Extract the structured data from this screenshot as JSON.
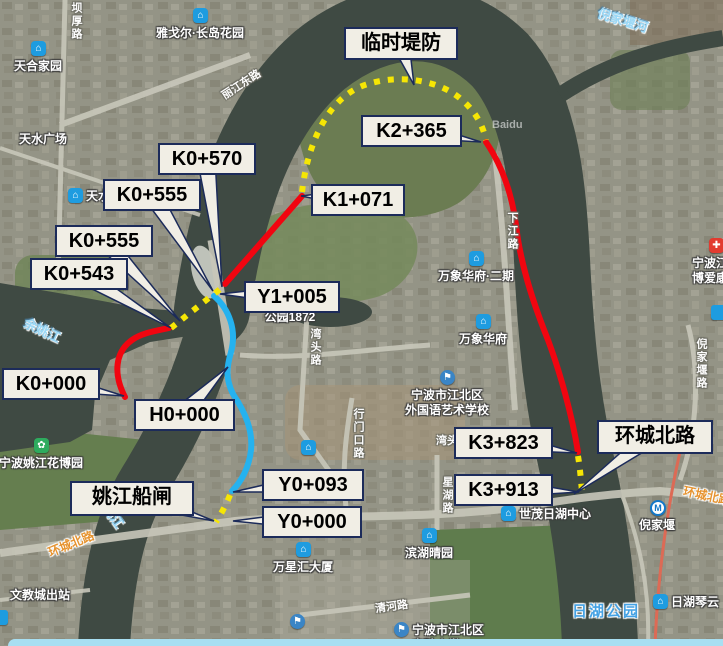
{
  "app": {
    "watermark": "Baidu"
  },
  "colors": {
    "route_red": "#f10510",
    "route_blue": "#25b2ef",
    "route_yellow": "#f6e604",
    "callout_bg": "#f1eee5",
    "callout_border": "#1c2b5a",
    "water": "#3f4a43",
    "land": "#8f9080",
    "bottom_bar": "#a8dff2"
  },
  "routes": {
    "red_solid": {
      "color": "#f10510",
      "segments": [
        {
          "id": "red-west",
          "d": "M125,397 C113,374 115,352 132,340 C142,333 155,331 169,328"
        },
        {
          "id": "red-bridge",
          "d": "M225,284 L302,196"
        },
        {
          "id": "red-east",
          "d": "M486,142 C503,167 512,195 516,225 C520,262 532,300 548,340 C560,372 572,415 578,452"
        }
      ]
    },
    "blue_solid": {
      "color": "#25b2ef",
      "segments": [
        {
          "id": "blue-main",
          "d": "M214,296 C229,309 237,330 231,352 C227,366 225,378 233,394 C245,412 253,430 251,450 C249,468 241,482 232,491"
        }
      ]
    },
    "yellow_dashed": {
      "color": "#f6e604",
      "segments": [
        {
          "id": "dike-arc",
          "d": "M302,192 C308,140 330,95 368,84 C400,74 440,80 462,100 C476,112 483,126 486,140"
        },
        {
          "id": "gap-west",
          "d": "M171,328 L224,286"
        },
        {
          "id": "gap-east-end",
          "d": "M578,456 C580,468 581,480 582,492"
        },
        {
          "id": "gap-south-end",
          "d": "M230,495 C226,505 221,514 216,522"
        }
      ]
    }
  },
  "callouts": [
    {
      "id": "linshi-difang",
      "label": "临时堤防",
      "box": [
        344,
        27,
        112,
        29
      ],
      "tip": [
        414,
        85
      ]
    },
    {
      "id": "k2-365",
      "label": "K2+365",
      "box": [
        361,
        115,
        99,
        28
      ],
      "tip": [
        481,
        142
      ]
    },
    {
      "id": "k1-071",
      "label": "K1+071",
      "box": [
        311,
        184,
        92,
        28
      ],
      "tip": [
        301,
        196
      ]
    },
    {
      "id": "k0-570",
      "label": "K0+570",
      "box": [
        158,
        143,
        96,
        28
      ],
      "tip": [
        222,
        287
      ]
    },
    {
      "id": "k0-555-a",
      "label": "K0+555",
      "box": [
        103,
        179,
        96,
        28
      ],
      "tip": [
        213,
        291
      ]
    },
    {
      "id": "k0-555-b",
      "label": "K0+555",
      "box": [
        55,
        225,
        96,
        28
      ],
      "tip": [
        180,
        321
      ]
    },
    {
      "id": "k0-543",
      "label": "K0+543",
      "box": [
        30,
        258,
        96,
        28
      ],
      "tip": [
        171,
        328
      ]
    },
    {
      "id": "y1-005",
      "label": "Y1+005",
      "box": [
        244,
        281,
        94,
        28
      ],
      "tip": [
        220,
        294
      ]
    },
    {
      "id": "k0-000",
      "label": "K0+000",
      "box": [
        2,
        368,
        96,
        28
      ],
      "tip": [
        124,
        396
      ]
    },
    {
      "id": "h0-000",
      "label": "H0+000",
      "box": [
        134,
        399,
        99,
        28
      ],
      "tip": [
        228,
        367
      ]
    },
    {
      "id": "y0-093",
      "label": "Y0+093",
      "box": [
        262,
        469,
        100,
        28
      ],
      "tip": [
        233,
        492
      ]
    },
    {
      "id": "y0-000",
      "label": "Y0+000",
      "box": [
        262,
        506,
        98,
        28
      ],
      "tip": [
        233,
        521
      ]
    },
    {
      "id": "yaojiang-chuanzha",
      "label": "姚江船闸",
      "box": [
        70,
        481,
        122,
        31
      ],
      "tip": [
        214,
        521
      ]
    },
    {
      "id": "k3-823",
      "label": "K3+823",
      "box": [
        454,
        427,
        97,
        28
      ],
      "tip": [
        577,
        453
      ]
    },
    {
      "id": "k3-913",
      "label": "K3+913",
      "box": [
        454,
        474,
        97,
        28
      ],
      "tip": [
        579,
        492
      ]
    },
    {
      "id": "huancheng-beilu",
      "label": "环城北路",
      "box": [
        597,
        420,
        114,
        30
      ],
      "tip": [
        574,
        494
      ]
    }
  ],
  "pois": [
    {
      "name": "雅戈尔·长岛花园",
      "type": "building",
      "x": 200,
      "y": 15,
      "labelpos": "below",
      "lines": [
        "雅戈尔·长岛花园"
      ]
    },
    {
      "name": "天合家园",
      "type": "building",
      "x": 38,
      "y": 48,
      "labelpos": "below",
      "lines": [
        "天合家园"
      ]
    },
    {
      "name": "天水家园",
      "type": "building",
      "x": 75,
      "y": 195,
      "labelpos": "right",
      "lines": [
        "天水家园"
      ]
    },
    {
      "name": "公园1872",
      "type": "building",
      "x": 290,
      "y": 299,
      "labelpos": "below",
      "lines": [
        "公园1872"
      ]
    },
    {
      "name": "万象华府·二期",
      "type": "building",
      "x": 476,
      "y": 258,
      "labelpos": "below",
      "lines": [
        "万象华府·二期"
      ]
    },
    {
      "name": "万象华府",
      "type": "building",
      "x": 483,
      "y": 321,
      "labelpos": "below",
      "lines": [
        "万象华府"
      ]
    },
    {
      "name": "世茂日湖中心",
      "type": "building",
      "x": 508,
      "y": 513,
      "labelpos": "right",
      "lines": [
        "世茂日湖中心"
      ]
    },
    {
      "name": "滨湖晴园",
      "type": "building",
      "x": 429,
      "y": 535,
      "labelpos": "below",
      "lines": [
        "滨湖晴园"
      ]
    },
    {
      "name": "万星汇大厦",
      "type": "building",
      "x": 303,
      "y": 549,
      "labelpos": "below",
      "lines": [
        "万星汇大厦"
      ]
    },
    {
      "name": "日湖琴云",
      "type": "building",
      "x": 660,
      "y": 601,
      "labelpos": "right",
      "lines": [
        "日湖琴云"
      ]
    },
    {
      "name": "unnamed-poi",
      "type": "building",
      "x": 308,
      "y": 447,
      "labelpos": "none",
      "lines": []
    },
    {
      "name": "宁波市江北区外国语艺术学校",
      "type": "flag",
      "x": 447,
      "y": 377,
      "labelpos": "below",
      "lines": [
        "宁波市江北区",
        "外国语艺术学校"
      ]
    },
    {
      "name": "宁波市江北区实验小学",
      "type": "flag",
      "x": 401,
      "y": 629,
      "labelpos": "right",
      "lines": [
        "宁波市江北区",
        "实验小学"
      ]
    },
    {
      "name": "unnamed-school-poi",
      "type": "flag",
      "x": 297,
      "y": 621,
      "labelpos": "none",
      "lines": []
    },
    {
      "name": "倪家堰",
      "type": "metro",
      "x": 657,
      "y": 507,
      "labelpos": "below",
      "lines": [
        "倪家堰"
      ]
    },
    {
      "name": "宁波姚江花博园",
      "type": "park",
      "x": 41,
      "y": 445,
      "labelpos": "below",
      "lines": [
        "宁波姚江花博园"
      ]
    },
    {
      "name": "宁波江北博爱康复医院",
      "type": "hospital",
      "x": 716,
      "y": 245,
      "labelpos": "below",
      "lines": [
        "宁波江北",
        "博爱康复"
      ]
    },
    {
      "name": "edge-chip-right",
      "type": "chip",
      "x": 718,
      "y": 312,
      "labelpos": "none",
      "lines": []
    },
    {
      "name": "edge-chip-left",
      "type": "chip",
      "x": 0,
      "y": 617,
      "labelpos": "none",
      "lines": []
    }
  ],
  "map_labels": [
    {
      "text": "天水广场",
      "style": "area",
      "x": 19,
      "y": 130,
      "rot": 0,
      "vertical": false
    },
    {
      "text": "新三江口公园",
      "style": "area",
      "x": 56,
      "y": 275,
      "rot": 0,
      "vertical": false
    },
    {
      "text": "文教城出站",
      "style": "area",
      "x": 10,
      "y": 586,
      "rot": 0,
      "vertical": false
    },
    {
      "text": "余姚江",
      "style": "water",
      "x": 23,
      "y": 320,
      "rot": 25,
      "vertical": false
    },
    {
      "text": "姚江",
      "style": "water",
      "x": 101,
      "y": 506,
      "rot": 55,
      "vertical": false
    },
    {
      "text": "倪家堰河",
      "style": "water",
      "x": 597,
      "y": 10,
      "rot": 17,
      "vertical": false
    },
    {
      "text": "坝厚路",
      "style": "road",
      "x": 68,
      "y": 2,
      "rot": 0,
      "vertical": true
    },
    {
      "text": "丽江东路",
      "style": "road",
      "x": 219,
      "y": 76,
      "rot": -33,
      "vertical": false
    },
    {
      "text": "湾头路",
      "style": "road",
      "x": 307,
      "y": 328,
      "rot": 0,
      "vertical": true
    },
    {
      "text": "湾头路",
      "style": "road",
      "x": 436,
      "y": 432,
      "rot": 0,
      "vertical": false
    },
    {
      "text": "星湖路",
      "style": "road",
      "x": 439,
      "y": 476,
      "rot": 0,
      "vertical": true
    },
    {
      "text": "下江路",
      "style": "road",
      "x": 504,
      "y": 212,
      "rot": 0,
      "vertical": true
    },
    {
      "text": "倪家堰路",
      "style": "road",
      "x": 693,
      "y": 338,
      "rot": 0,
      "vertical": true
    },
    {
      "text": "行门口路",
      "style": "road",
      "x": 350,
      "y": 408,
      "rot": 0,
      "vertical": true
    },
    {
      "text": "清河路",
      "style": "road",
      "x": 375,
      "y": 598,
      "rot": -8,
      "vertical": false
    },
    {
      "text": "环城北路",
      "style": "road-orange",
      "x": 47,
      "y": 535,
      "rot": -22,
      "vertical": false
    },
    {
      "text": "环城北路",
      "style": "road-orange",
      "x": 683,
      "y": 487,
      "rot": 12,
      "vertical": false
    },
    {
      "text": "日湖公园",
      "style": "park-blue",
      "x": 572,
      "y": 600,
      "rot": 0,
      "vertical": false
    }
  ],
  "watermark": {
    "text": "Baidu",
    "x": 492,
    "y": 119
  }
}
